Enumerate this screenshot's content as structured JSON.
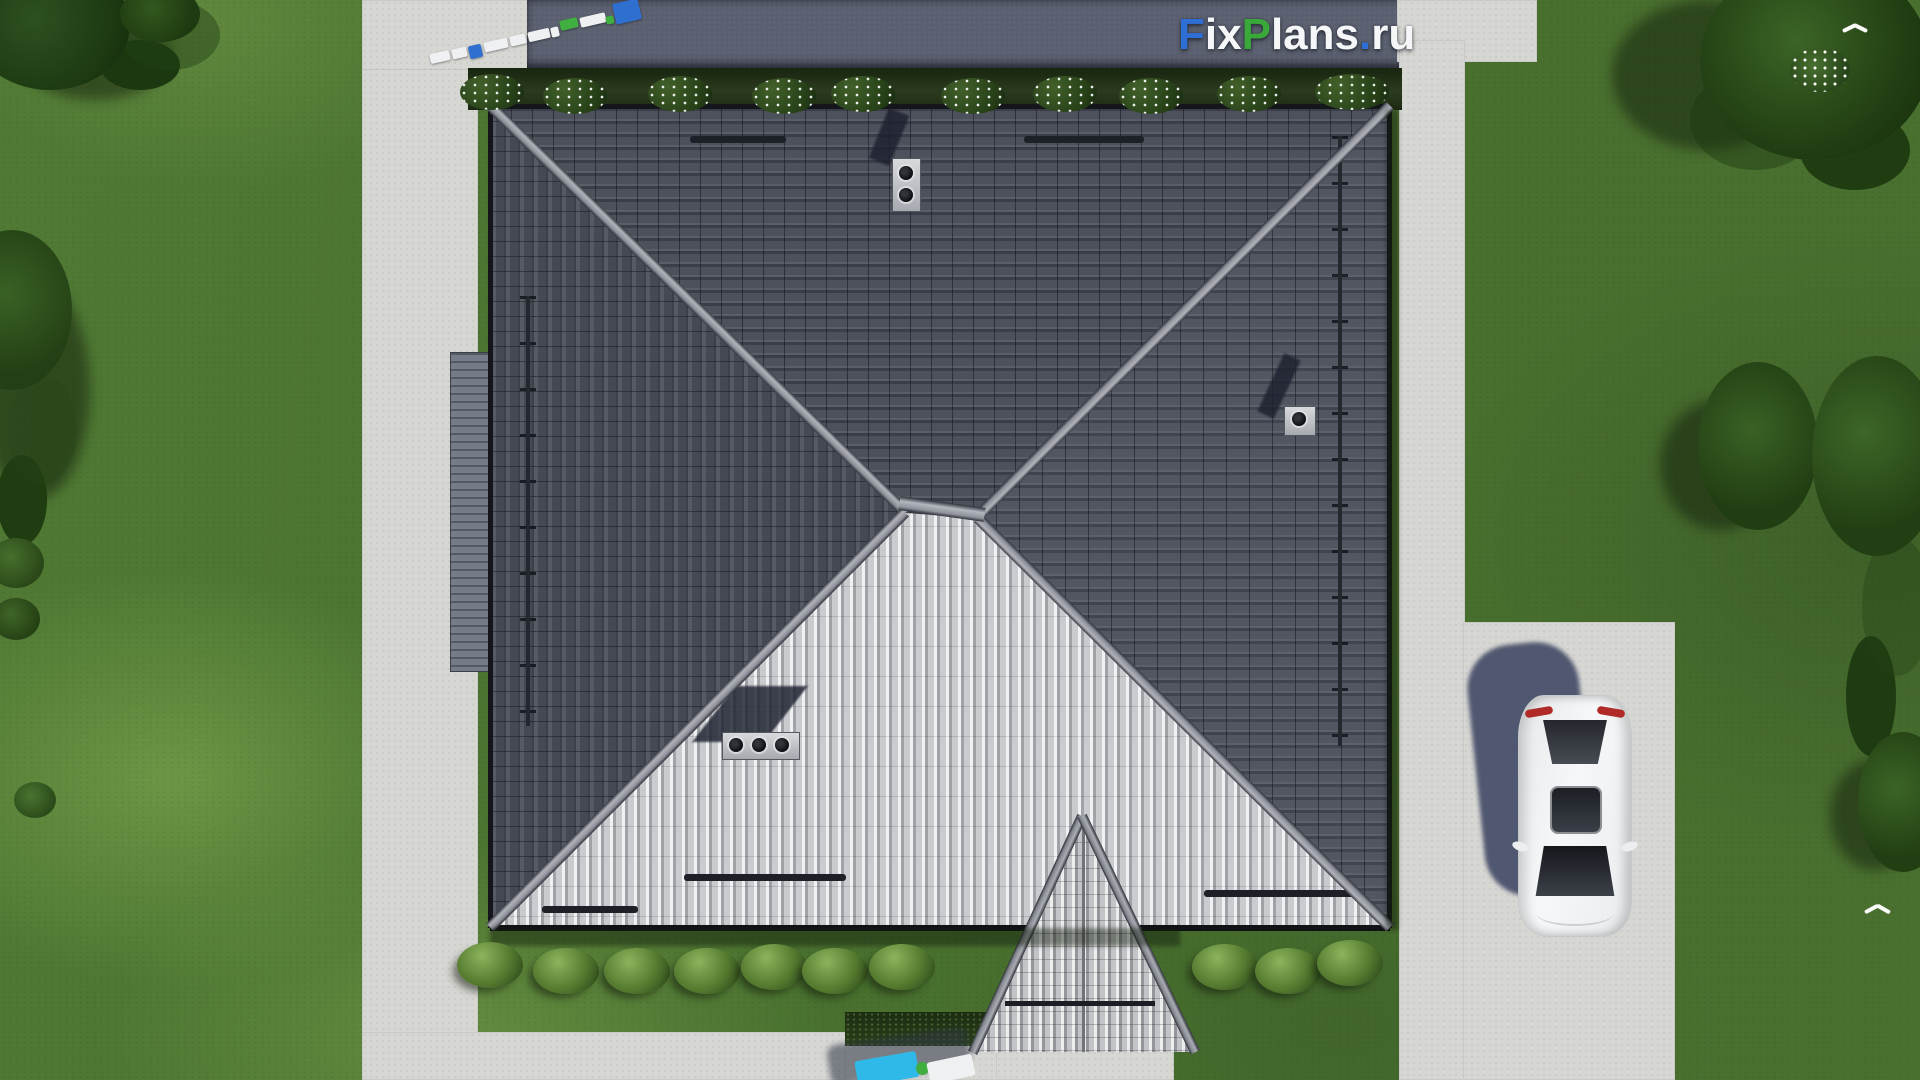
{
  "watermark": {
    "f": "F",
    "ix": "ix",
    "p": "P",
    "lans": "lans",
    "dot": ".",
    "ru": "ru",
    "full_text": "FixPlans.ru"
  },
  "colors": {
    "logo_blue": "#2e6fd6",
    "logo_green": "#3aa93a",
    "logo_white": "#f4f6f8",
    "lawn": "#4b7230",
    "lawn_light": "#79a24a",
    "lawn_dark": "#35521f",
    "concrete": "#d6d6d3",
    "road": "#5b6070",
    "roof_dark": "#4d515c",
    "roof_dark_line": "#3a3e48",
    "roof_light": "#c9cbce",
    "roof_rib": "#f0f1f2",
    "ridge_cap": "#a4a7ae",
    "hedge": "#24371c",
    "bush_dark": "#27401a",
    "bush_light": "#8cb45c",
    "flower_white": "#ffffff",
    "wall_gray": "#767b88",
    "chimney_cap": "#c0c2c6",
    "car_white": "#f1f2f3",
    "car_glass": "#1c1f26",
    "car_taillight": "#b02a28",
    "car_shadow": "#3f4765",
    "fence_white": "#eef0f2",
    "fence_blue": "#2f6fd0",
    "fence_green": "#3faf3f",
    "playground_cyan": "#2fb9e8",
    "playground_green": "#3fae3f"
  }
}
